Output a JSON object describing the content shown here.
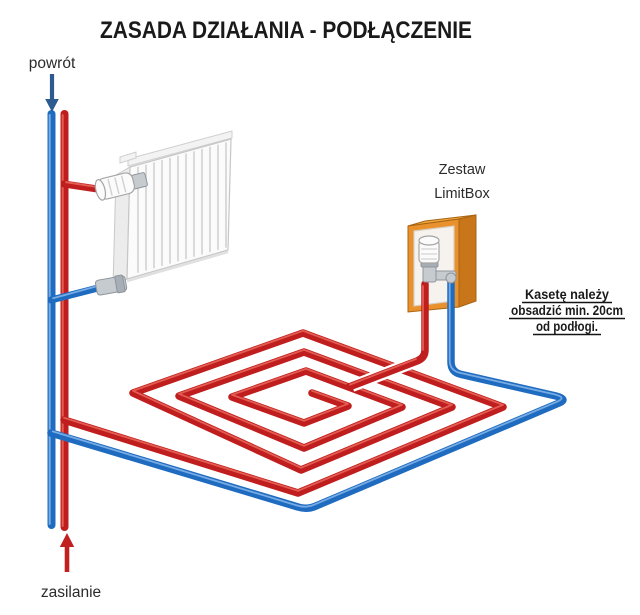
{
  "title": "ZASADA DZIAŁANIA - PODŁĄCZENIE",
  "labels": {
    "return": "powrót",
    "supply": "zasilanie",
    "kit_line1": "Zestaw",
    "kit_line2": "LimitBox"
  },
  "note": {
    "line1": "Kasetę należy",
    "line2": "obsadzić min. 20cm",
    "line3": "od podłogi."
  },
  "colors": {
    "text": "#1a1a1a",
    "text_soft": "#2b2b2b",
    "supply_pipe": "#c01e1e",
    "supply_pipe_light": "#e9685c",
    "return_pipe": "#1f6bc0",
    "return_pipe_light": "#7fb3e8",
    "supply_arrow": "#c02020",
    "return_arrow": "#2e5b8f",
    "cabinet_orange": "#e8912d",
    "cabinet_orange_dark": "#c9761b",
    "cabinet_orange_light": "#f2a93f"
  }
}
